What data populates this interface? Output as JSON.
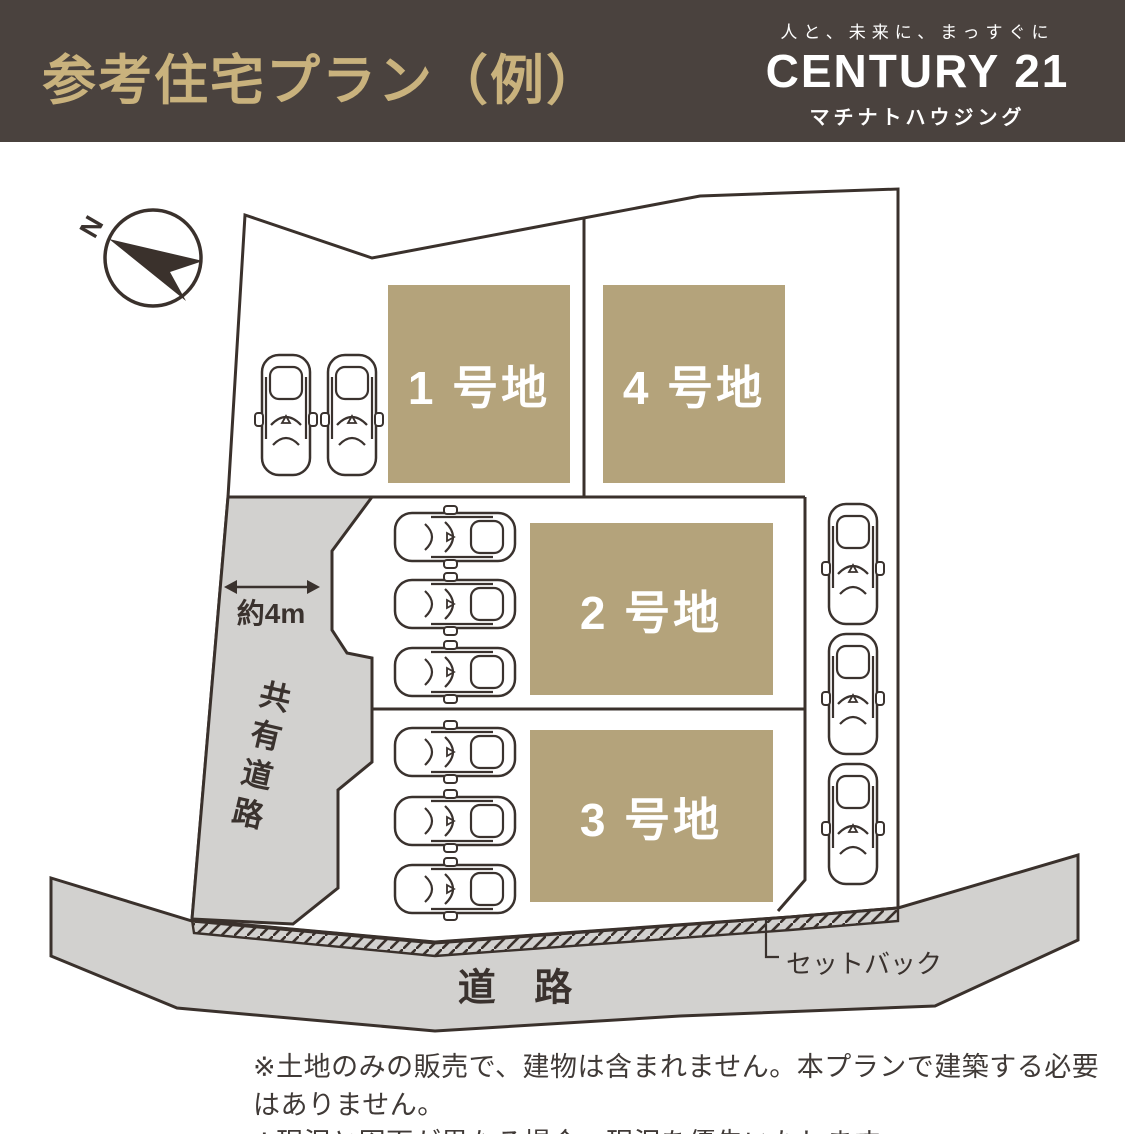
{
  "header": {
    "title": "参考住宅プラン（例）",
    "brand": {
      "tagline": "人と、未来に、まっすぐに",
      "name": "CENTURY 21",
      "company": "マチナトハウジング"
    }
  },
  "plan": {
    "compass": {
      "north_label": "N"
    },
    "lots": [
      {
        "id": "lot-1",
        "label": "1 号地"
      },
      {
        "id": "lot-2",
        "label": "2 号地"
      },
      {
        "id": "lot-3",
        "label": "3 号地"
      },
      {
        "id": "lot-4",
        "label": "4 号地"
      }
    ],
    "annotations": {
      "shared_road_width": "約4m",
      "shared_road": "共有道路",
      "road": "道 路",
      "setback": "セットバック"
    },
    "car_count": 11
  },
  "notes": [
    "※土地のみの販売で、建物は含まれません。本プランで建築する必要はありません。",
    "※現況と図面が異なる場合、現況を優先いたします。"
  ],
  "colors": {
    "header_bg": "#4a423e",
    "accent_gold": "#c9b27d",
    "lot_fill": "#b4a37b",
    "road_gray": "#d2d1cf",
    "line_dark": "#3a312c",
    "label_white": "#ffffff"
  }
}
